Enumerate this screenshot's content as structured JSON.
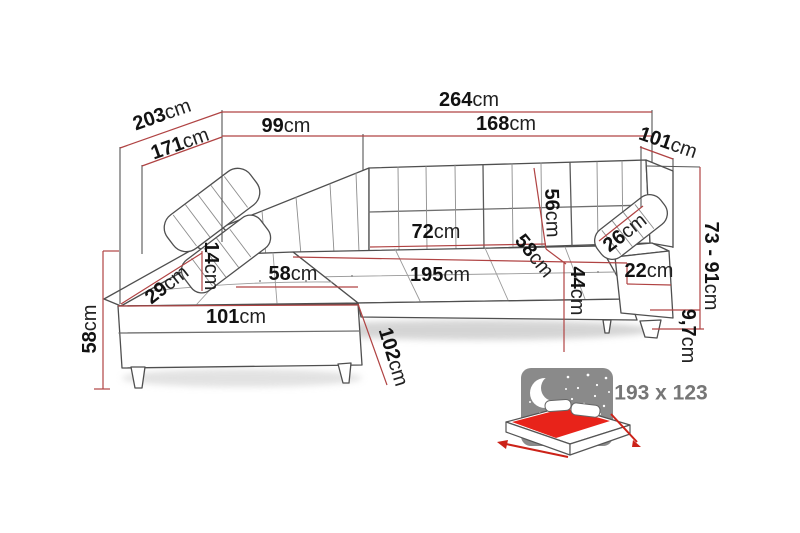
{
  "figure": {
    "type": "furniture-dimension-diagram",
    "subject": "corner sofa with chaise longue and sleeping function"
  },
  "dims": {
    "d203": {
      "value": "203",
      "unit": "cm"
    },
    "d171": {
      "value": "171",
      "unit": "cm"
    },
    "d99": {
      "value": "99",
      "unit": "cm"
    },
    "d264": {
      "value": "264",
      "unit": "cm"
    },
    "d168": {
      "value": "168",
      "unit": "cm"
    },
    "d101r": {
      "value": "101",
      "unit": "cm"
    },
    "d7391": {
      "value": "73 - 91",
      "unit": "cm"
    },
    "d97": {
      "value": "9,7",
      "unit": "cm"
    },
    "d56": {
      "value": "56",
      "unit": "cm"
    },
    "d58r": {
      "value": "58",
      "unit": "cm"
    },
    "d44": {
      "value": "44",
      "unit": "cm"
    },
    "d26": {
      "value": "26",
      "unit": "cm"
    },
    "d22": {
      "value": "22",
      "unit": "cm"
    },
    "d72": {
      "value": "72",
      "unit": "cm"
    },
    "d14": {
      "value": "14",
      "unit": "cm"
    },
    "d29": {
      "value": "29",
      "unit": "cm"
    },
    "d58l": {
      "value": "58",
      "unit": "cm"
    },
    "d101b": {
      "value": "101",
      "unit": "cm"
    },
    "d58v": {
      "value": "58",
      "unit": "cm"
    },
    "d102": {
      "value": "102",
      "unit": "cm"
    },
    "d195": {
      "value": "195",
      "unit": "cm"
    }
  },
  "sleeping_area": {
    "label": "193 x 123"
  },
  "colors": {
    "dimension_line": "#b04343",
    "outline": "#4f4f4f",
    "night_sky": "#8a8a8a",
    "mattress_red": "#e8231a",
    "arrow_red": "#cc2218",
    "size_text": "#767676"
  }
}
